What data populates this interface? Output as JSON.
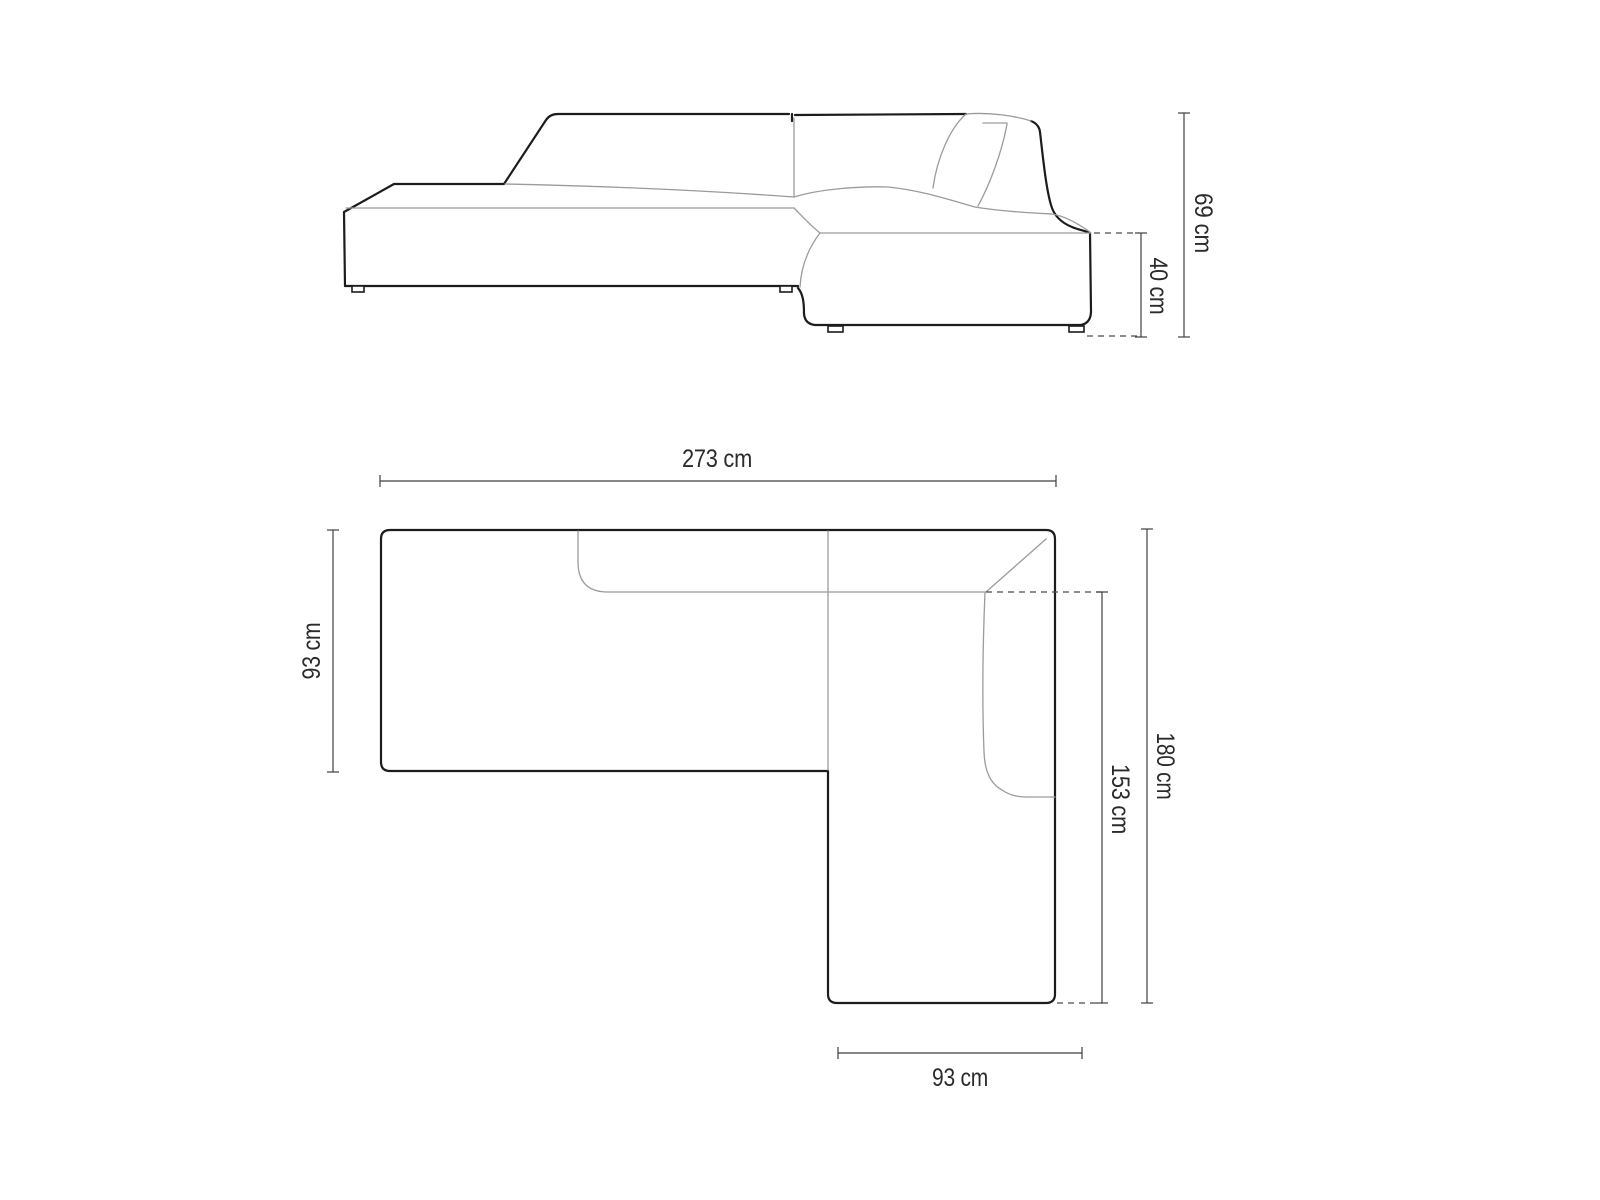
{
  "diagram": {
    "side_view": {
      "dimensions": {
        "total_height": "69 cm",
        "seat_height": "40 cm"
      }
    },
    "top_view": {
      "dimensions": {
        "total_width": "273 cm",
        "left_depth": "93 cm",
        "total_depth": "180 cm",
        "inner_length": "153 cm",
        "chaise_width": "93 cm"
      }
    },
    "colors": {
      "outline": "#1c1c1c",
      "seam": "#9b9b9b",
      "dimension_line": "#3f3f3f",
      "text": "#2b2b2b",
      "background": "#ffffff"
    }
  }
}
